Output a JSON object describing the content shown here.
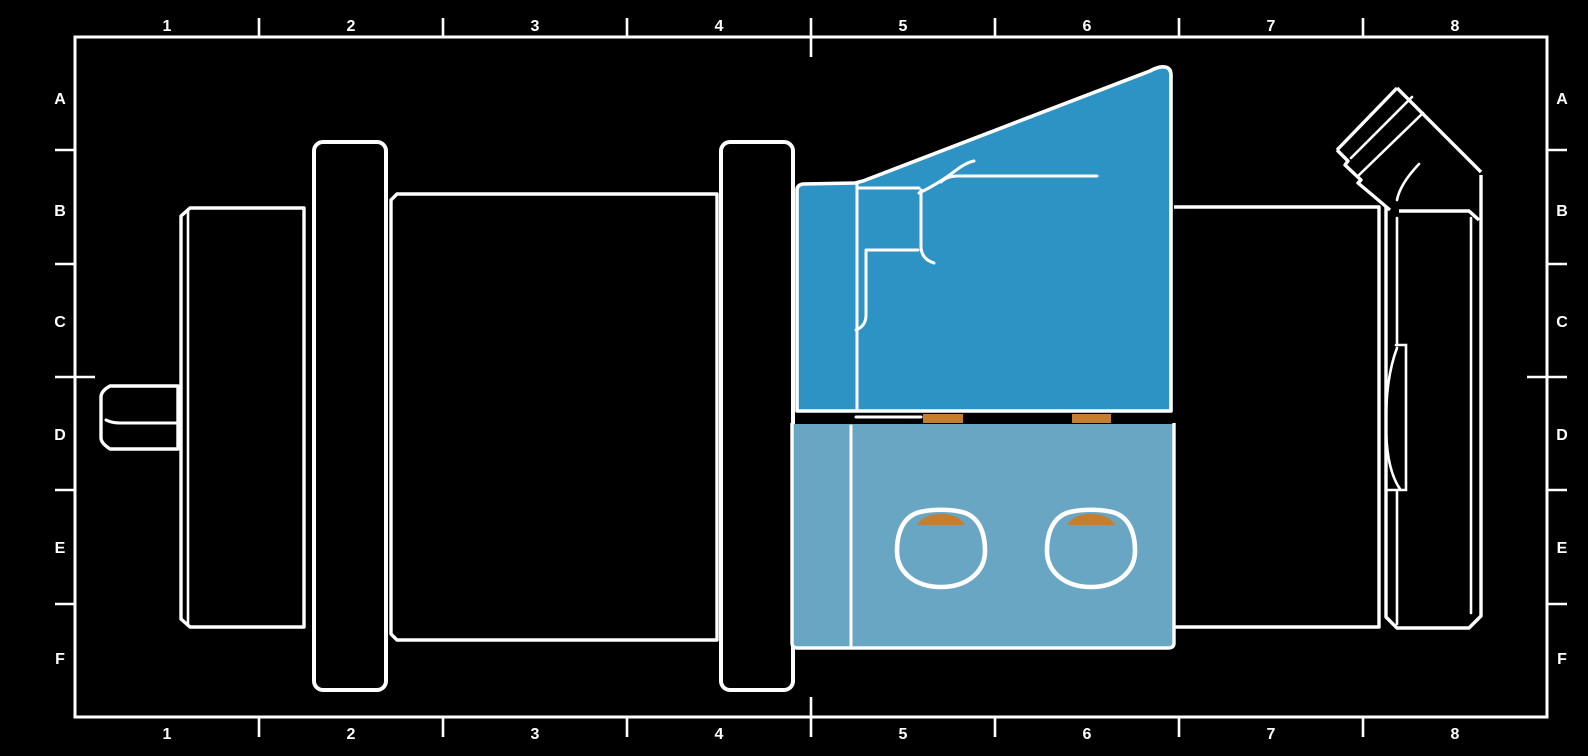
{
  "page": {
    "background": "#000000",
    "width": 1588,
    "height": 756
  },
  "frame": {
    "stroke": "#ffffff",
    "columns": [
      "1",
      "2",
      "3",
      "4",
      "5",
      "6",
      "7",
      "8"
    ],
    "rows": [
      "A",
      "B",
      "C",
      "D",
      "E",
      "F"
    ]
  },
  "drawing": {
    "view": "pump-assembly-side-section",
    "colors": {
      "outline": "#ffffff",
      "part_fill": "#000000",
      "highlight_dark_blue": "#2d92c4",
      "highlight_light_blue": "#69a6c3",
      "seal_orange": "#c57e30"
    },
    "parts": [
      {
        "name": "drive-shaft",
        "highlighted": false
      },
      {
        "name": "rear-housing",
        "highlighted": false
      },
      {
        "name": "rear-mounting-flange",
        "highlighted": false
      },
      {
        "name": "center-housing",
        "highlighted": false
      },
      {
        "name": "front-mounting-flange",
        "highlighted": false
      },
      {
        "name": "upper-valve-block",
        "highlighted": true,
        "fill": "#2d92c4"
      },
      {
        "name": "lower-manifold-block",
        "highlighted": true,
        "fill": "#69a6c3"
      },
      {
        "name": "seal-strip-left",
        "fill": "#c57e30"
      },
      {
        "name": "seal-strip-right",
        "fill": "#c57e30"
      },
      {
        "name": "port-opening-left",
        "highlighted": true
      },
      {
        "name": "port-opening-right",
        "highlighted": true
      },
      {
        "name": "main-housing",
        "highlighted": false
      },
      {
        "name": "end-cap",
        "highlighted": false
      },
      {
        "name": "elbow-fitting",
        "highlighted": false
      }
    ]
  }
}
